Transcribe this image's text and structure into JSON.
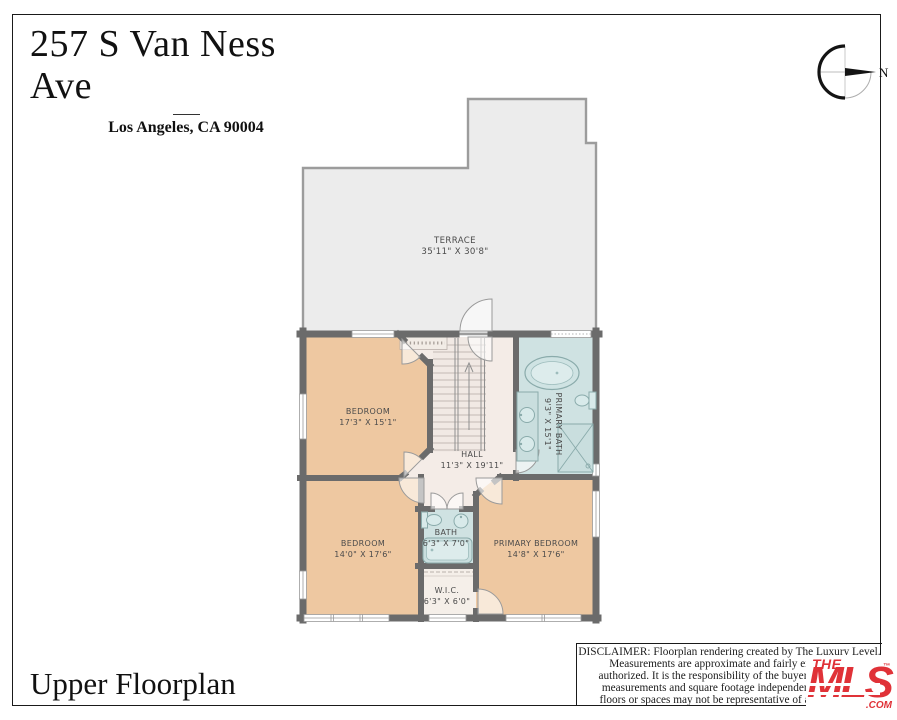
{
  "header": {
    "title": "257 S Van Ness Ave",
    "subtitle": "Los Angeles, CA 90004"
  },
  "compass": {
    "north_label": "N"
  },
  "rooms": {
    "terrace": {
      "name": "TERRACE",
      "dims": "35'11\" X 30'8\""
    },
    "bedroom1": {
      "name": "BEDROOM",
      "dims": "17'3\" X 15'1\""
    },
    "hall": {
      "name": "HALL",
      "dims": "11'3\" X 19'11\""
    },
    "primary_bath": {
      "name": "PRIMARY BATH",
      "dims": "9'3\" X 15'1\""
    },
    "bedroom2": {
      "name": "BEDROOM",
      "dims": "14'0\" X 17'6\""
    },
    "bath": {
      "name": "BATH",
      "dims": "6'3\" X 7'0\""
    },
    "primary_bedroom": {
      "name": "PRIMARY BEDROOM",
      "dims": "14'8\" X 17'6\""
    },
    "wic": {
      "name": "W.I.C.",
      "dims": "6'3\" X 6'0\""
    }
  },
  "footer": {
    "floor_label": "Upper Floorplan"
  },
  "disclaimer": {
    "lines": [
      "DISCLAIMER: Floorplan rendering created by The Luxury Level.",
      "Measurements are approximate and fairly exact but n",
      "authorized. It is the responsibility of the buyer to verify th",
      "measurements and square footage independently. Multip",
      "floors or spaces may not be representative of actual locati"
    ]
  },
  "logo": {
    "the": "THE",
    "mls": "MLS",
    "com": ".COM",
    "tm": "™"
  },
  "colors": {
    "walls": "#6b6b6b",
    "terrace_fill": "#ececec",
    "bedroom_fill": "#eec8a1",
    "hall_fill": "#f4ece7",
    "bath_fill": "#cfe2e2",
    "closet_fill": "#f5efe9",
    "logo_red": "#e03238"
  }
}
